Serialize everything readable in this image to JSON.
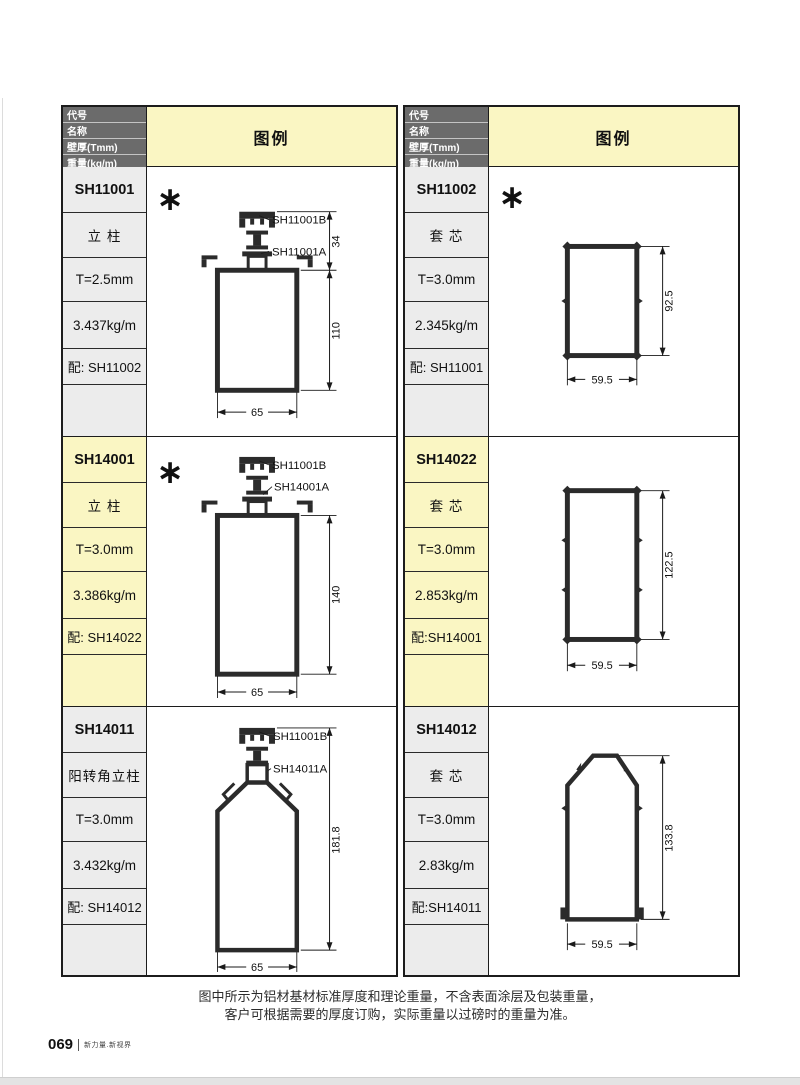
{
  "header": {
    "rows": [
      "代号",
      "名称",
      "壁厚(Tmm)",
      "重量(kg/m)",
      "配套"
    ],
    "legend": "图例"
  },
  "colors": {
    "header_bg": "#6b6b6b",
    "legend_yellow": "#faf6c3",
    "cell_gray": "#ececec",
    "line": "#1c1c1c"
  },
  "tables": [
    {
      "blocks": [
        {
          "code": "SH11001",
          "name": "立 柱",
          "thickness": "T=2.5mm",
          "weight": "3.437kg/m",
          "mate": "配: SH11002",
          "asterisk": "∗",
          "figure": {
            "label_b": "SH11001B",
            "label_a": "SH11001A",
            "dim_top": "34",
            "dim_height": "110",
            "dim_width": "65"
          }
        },
        {
          "code": "SH14001",
          "name": "立 柱",
          "thickness": "T=3.0mm",
          "weight": "3.386kg/m",
          "mate": "配: SH14022",
          "asterisk": "∗",
          "figure": {
            "label_b": "SH11001B",
            "label_a": "SH14001A",
            "dim_height": "140",
            "dim_width": "65"
          }
        },
        {
          "code": "SH14011",
          "name": "阳转角立柱",
          "thickness": "T=3.0mm",
          "weight": "3.432kg/m",
          "mate": "配: SH14012",
          "figure": {
            "label_b": "SH11001B",
            "label_a": "SH14011A",
            "dim_height": "181.8",
            "dim_width": "65"
          }
        }
      ]
    },
    {
      "blocks": [
        {
          "code": "SH11002",
          "name": "套 芯",
          "thickness": "T=3.0mm",
          "weight": "2.345kg/m",
          "mate": "配: SH11001",
          "asterisk": "∗",
          "figure": {
            "dim_height": "92.5",
            "dim_width": "59.5"
          }
        },
        {
          "code": "SH14022",
          "name": "套 芯",
          "thickness": "T=3.0mm",
          "weight": "2.853kg/m",
          "mate": "配:SH14001",
          "figure": {
            "dim_height": "122.5",
            "dim_width": "59.5"
          }
        },
        {
          "code": "SH14012",
          "name": "套 芯",
          "thickness": "T=3.0mm",
          "weight": "2.83kg/m",
          "mate": "配:SH14011",
          "figure": {
            "dim_height": "133.8",
            "dim_width": "59.5"
          }
        }
      ]
    }
  ],
  "footer": {
    "note_line1": "图中所示为铝材基材标准厚度和理论重量，不含表面涂层及包装重量，",
    "note_line2": "客户可根据需要的厚度订购，实际重量以过磅时的重量为准。",
    "page_number": "069",
    "brand": "新力量.新视界"
  }
}
